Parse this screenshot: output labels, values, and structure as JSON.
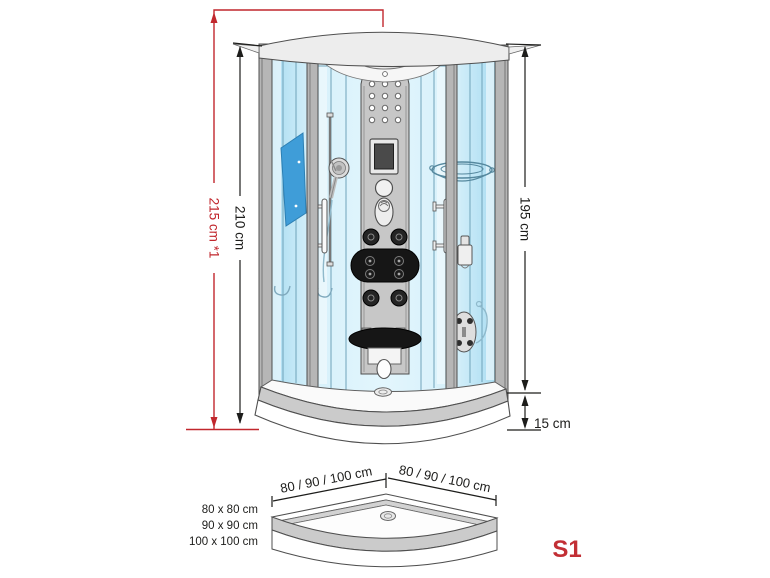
{
  "labels": {
    "height_total": "215 cm *1",
    "height_cabin": "210 cm",
    "height_door": "195 cm",
    "height_tray": "15 cm",
    "tray_width_left": "80 / 90 / 100 cm",
    "tray_width_right": "80 / 90 / 100 cm",
    "sizes": [
      "80 x 80 cm",
      "90 x 90 cm",
      "100 x 100 cm"
    ],
    "model": "S1"
  },
  "colors": {
    "dimension_red": "#c1272d",
    "model_red": "#c22f35",
    "text_ink": "#1d1d1b",
    "outline_gray": "#4f4f4f",
    "frame_gray": "#b6b6b6",
    "panel_gray": "#c7c7c7",
    "canopy_gray": "#ededed",
    "tray_band_gray": "#cbcbcb",
    "glass_blue": "#a9dcf1",
    "glass_light": "#d6f0fa",
    "glass_dark_panel": "#3f9dd8"
  }
}
